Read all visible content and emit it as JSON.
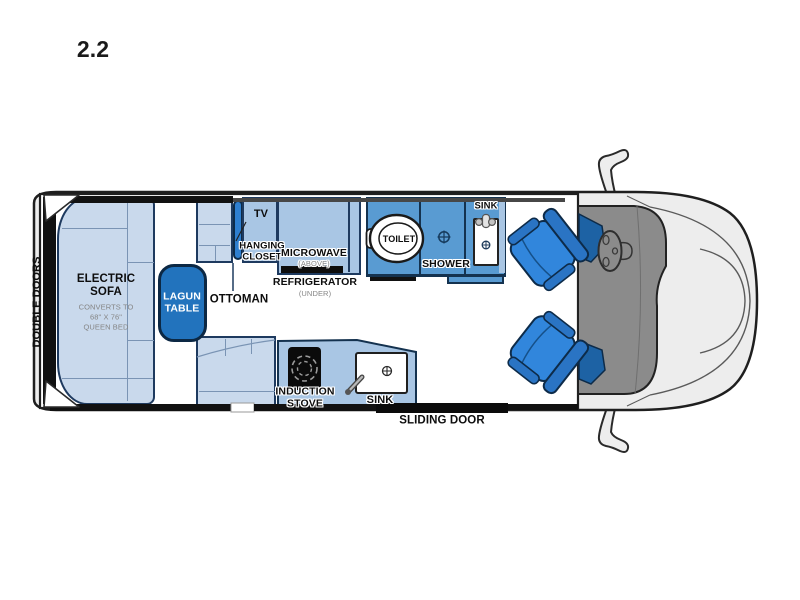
{
  "title": "2.2",
  "labels": {
    "double_doors": "DOUBLE DOORS",
    "electric_sofa": "ELECTRIC\nSOFA",
    "sofa_note": "CONVERTS TO\n68\" X 76\"\nQUEEN BED",
    "lagun_table": "LAGUN\nTABLE",
    "ottoman": "OTTOMAN",
    "tv": "TV",
    "hanging_closet": "HANGING\nCLOSET",
    "microwave": "MICROWAVE",
    "microwave_note": "(ABOVE)",
    "refrigerator": "REFRIGERATOR",
    "refrigerator_note": "(UNDER)",
    "toilet": "TOILET",
    "shower": "SHOWER",
    "bathroom_sink": "SINK",
    "induction_stove": "INDUCTION\nSTOVE",
    "kitchen_sink": "SINK",
    "sliding_door": "SLIDING DOOR"
  },
  "colors": {
    "furniture_light_blue": "#c9d9ec",
    "cabinet_medium_blue": "#a9c6e4",
    "bathroom_blue": "#599bd2",
    "accent_blue": "#2273bd",
    "chair_blue": "#3186dc",
    "dashboard_gray": "#8b8b8b",
    "body_gray": "#ededed",
    "wall_black": "#111111"
  }
}
